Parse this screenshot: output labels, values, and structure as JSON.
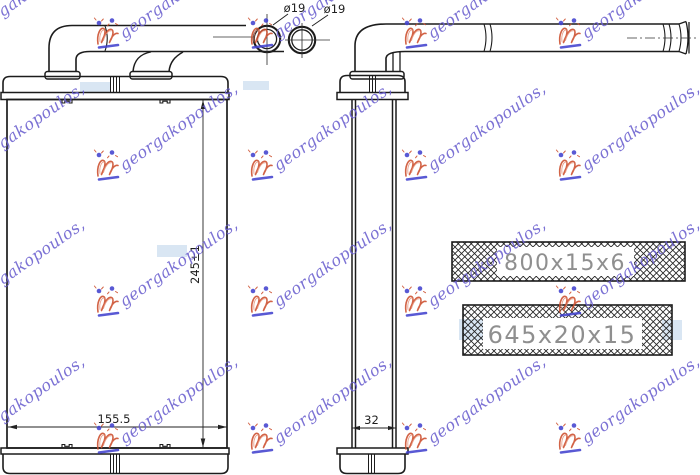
{
  "watermark": {
    "text": "georgakopoulos,",
    "text_color": "#6a5fcf",
    "logo_color": "#cc4e2d",
    "logo_accent_color": "#4343cf",
    "patch_color": "#b9d2e9",
    "columns": [
      -46,
      107,
      261,
      415,
      569
    ],
    "rows": [
      35,
      167,
      303,
      440
    ],
    "patches": [
      {
        "x": 80,
        "y": 82,
        "w": 30,
        "h": 10
      },
      {
        "x": 243,
        "y": 81,
        "w": 26,
        "h": 9
      },
      {
        "x": 157,
        "y": 245,
        "w": 30,
        "h": 12
      },
      {
        "x": 459,
        "y": 319,
        "w": 24,
        "h": 21
      },
      {
        "x": 662,
        "y": 320,
        "w": 20,
        "h": 20
      }
    ]
  },
  "drawing": {
    "line_color": "#1c1c1c",
    "front_view": {
      "width_label": "155.5",
      "height_label": "245±1",
      "port_diameter_labels": [
        "ø19",
        "ø19"
      ]
    },
    "side_view": {
      "depth_label": "32"
    },
    "spec_bars": [
      {
        "label": "800x15x6"
      },
      {
        "label": "645x20x15"
      }
    ]
  }
}
